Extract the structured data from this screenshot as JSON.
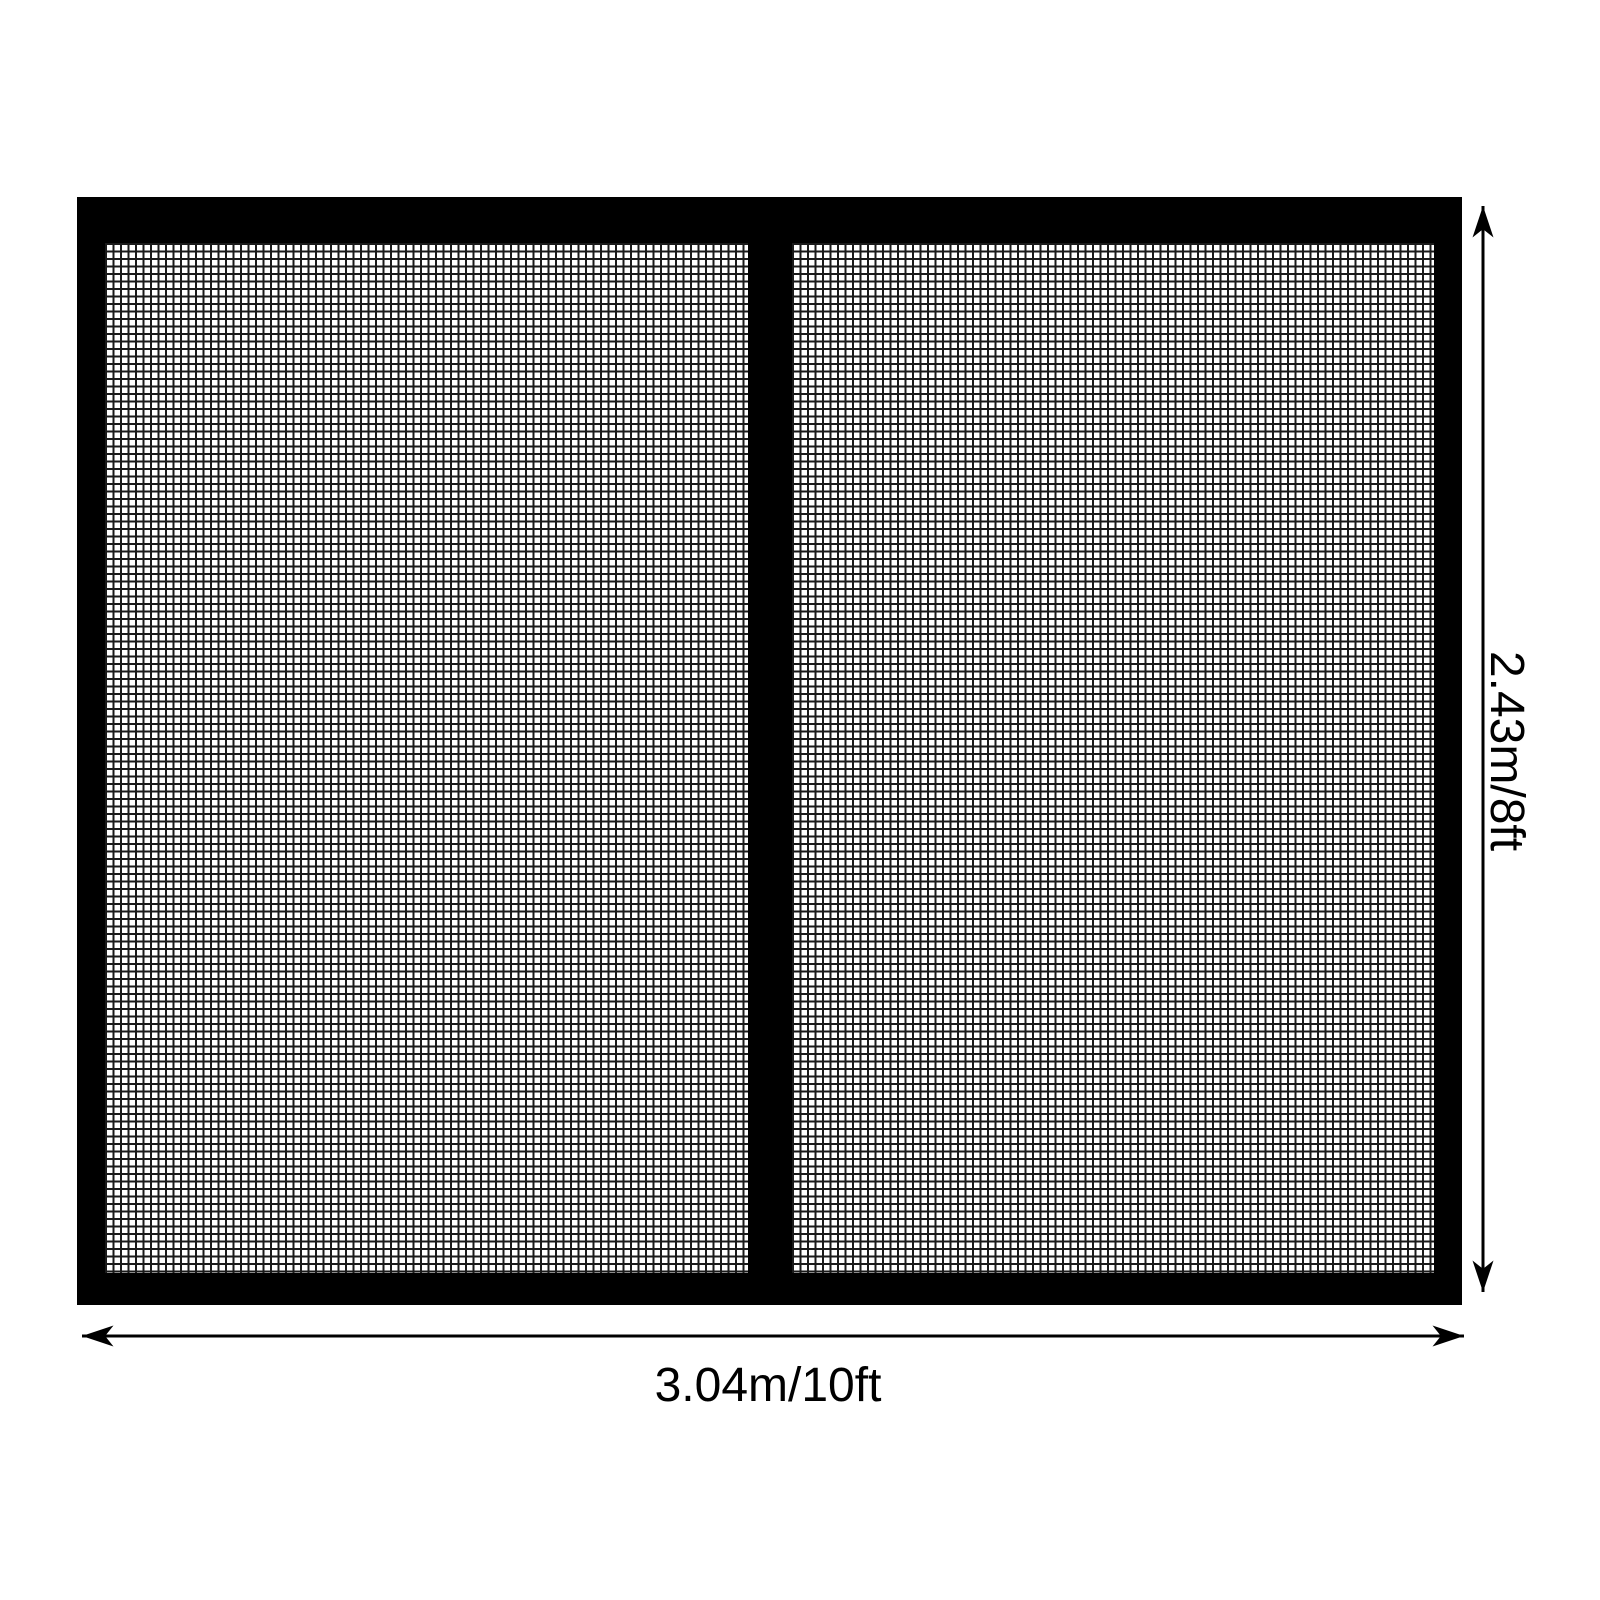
{
  "diagram": {
    "background_color": "#ffffff",
    "frame_color": "#000000",
    "mesh_line_color": "#1a1a1a",
    "arrow_color": "#000000",
    "text_color": "#000000",
    "panel_count": 2,
    "dimensions": {
      "height": {
        "label": "2.43m/8ft"
      },
      "width": {
        "label": "3.04m/10ft"
      }
    }
  }
}
